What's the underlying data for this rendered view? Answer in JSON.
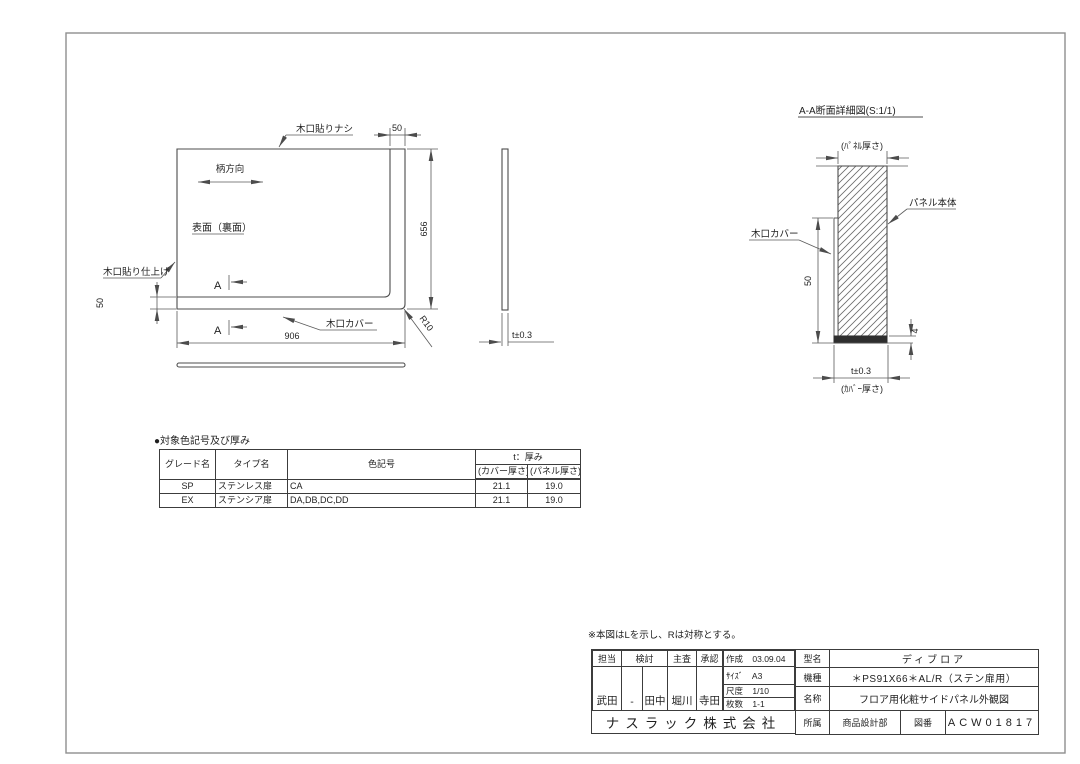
{
  "main_view": {
    "edge_top_label": "木口貼りナシ",
    "grain_label": "柄方向",
    "surface_label": "表面（裏面）",
    "edge_left_label": "木口貼り仕上げ",
    "cover_label": "木口カバー",
    "section_mark": "A",
    "dim_top": "50",
    "dim_right": "656",
    "dim_left": "50",
    "dim_bottom": "906",
    "radius": "R10"
  },
  "side_view": {
    "thickness_dim": "t±0.3"
  },
  "section_view": {
    "title": "A-A断面詳細図(S:1/1)",
    "panel_thickness_label": "(ﾊﾟﾈﾙ厚さ)",
    "panel_label": "パネル本体",
    "cover_label": "木口カバー",
    "height_dim": "50",
    "cover_bottom_dim": "4",
    "thickness_dim": "t±0.3",
    "cover_thickness_label": "(ｶﾊﾞｰ厚さ)"
  },
  "color_table": {
    "title": "●対象色記号及び厚み",
    "headers": {
      "grade": "グレード名",
      "type": "タイプ名",
      "color": "色記号",
      "thickness": "t：厚み",
      "cover": "(カバー厚さ)",
      "panel": "(パネル厚さ)"
    },
    "rows": [
      {
        "grade": "SP",
        "type": "ステンレス扉",
        "color": "CA",
        "cover": "21.1",
        "panel": "19.0"
      },
      {
        "grade": "EX",
        "type": "ステンシア扉",
        "color": "DA,DB,DC,DD",
        "cover": "21.1",
        "panel": "19.0"
      }
    ]
  },
  "note": "※本図はLを示し、Rは対称とする。",
  "title_block": {
    "labels": {
      "tanto": "担当",
      "kento": "検討",
      "shusa": "主査",
      "shonin": "承認",
      "sakusei": "作成",
      "size": "ｻｲｽﾞ",
      "scale": "尺度",
      "sheets": "枚数",
      "model": "型名",
      "machine": "機種",
      "name": "名称",
      "dept": "所属",
      "dwgno": "図番"
    },
    "values": {
      "date": "03.09.04",
      "size": "A3",
      "scale": "1/10",
      "sheets": "1-1",
      "model": "ディブロア",
      "machine": "＊PS91X66＊AL/R（ステン扉用）",
      "name": "フロア用化粧サイドパネル外観図",
      "dept": "商品設計部",
      "dwgno": "ACW01817"
    },
    "signatures": [
      "武田",
      "-",
      "田中",
      "堀川",
      "寺田"
    ],
    "company": "ナスラック株式会社"
  }
}
